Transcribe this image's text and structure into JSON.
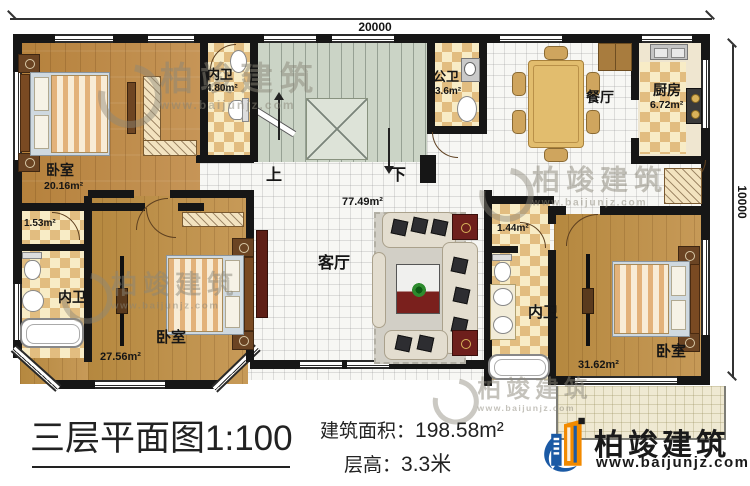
{
  "dimensions": {
    "width_label": "20000",
    "height_label": "10000"
  },
  "rooms": {
    "bedroom_tl": {
      "name": "卧室",
      "area": "20.16m²"
    },
    "bath_tl": {
      "name": "内卫",
      "area": "4.80m²"
    },
    "pub_bath": {
      "name": "公卫",
      "area": "3.6m²"
    },
    "dining": {
      "name": "餐厅"
    },
    "kitchen": {
      "name": "厨房",
      "area": "6.72m²"
    },
    "living": {
      "name": "客厅",
      "area": "77.49m²"
    },
    "closet_left": {
      "area": "1.53m²"
    },
    "bath_bl": {
      "name": "内卫"
    },
    "bedroom_bl": {
      "name": "卧室",
      "area": "27.56m²"
    },
    "closet_right": {
      "area": "1.44m²"
    },
    "bath_br": {
      "name": "内卫"
    },
    "bedroom_br": {
      "name": "卧室",
      "area": "31.62m²"
    }
  },
  "stairs": {
    "up": "上",
    "down": "下"
  },
  "title_block": {
    "title": "三层平面图1:100",
    "area_label": "建筑面积：",
    "area_value": "198.58m²",
    "floor_height_label": "层高：",
    "floor_height_value": "3.3米"
  },
  "brand": {
    "name": "柏竣建筑",
    "url": "www.baijunjz.com"
  },
  "colors": {
    "wall": "#161616",
    "logo_blue": "#1b5aa5",
    "logo_orange": "#f28a00"
  }
}
